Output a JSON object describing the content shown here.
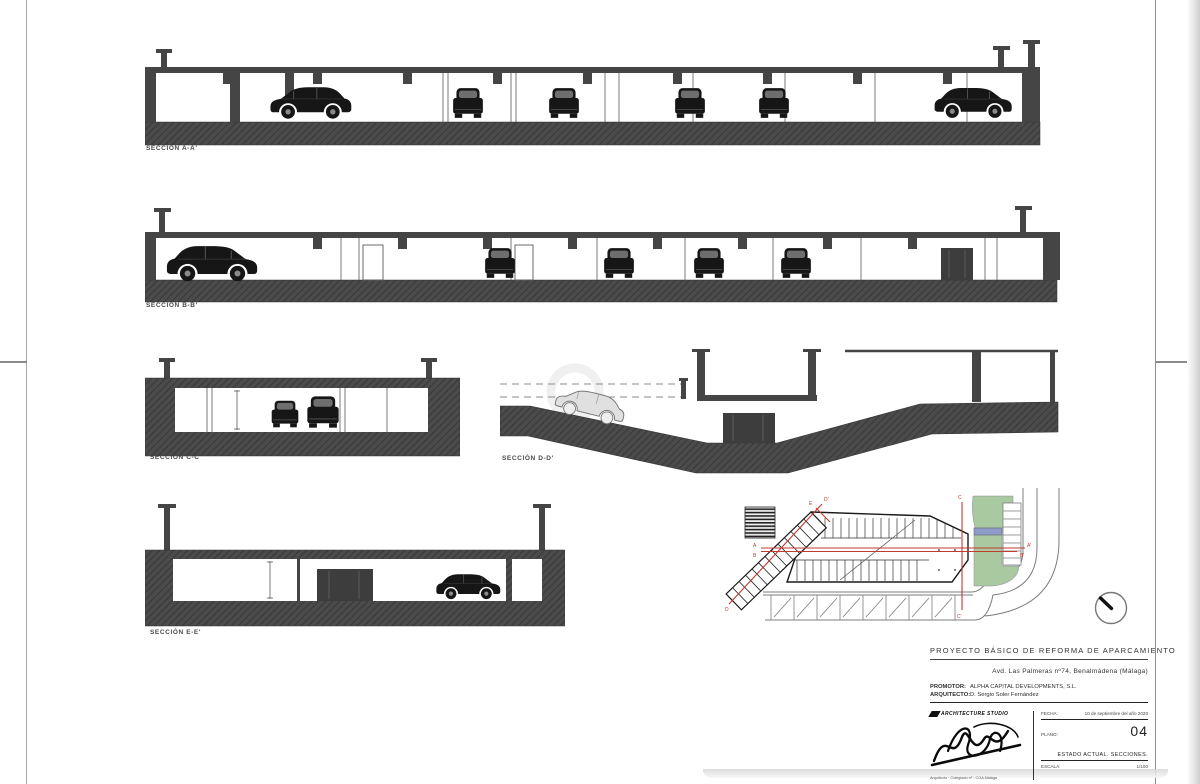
{
  "doc": {
    "type_note": "Scanned architecture sheet – parking reform sections",
    "colors": {
      "ink": "#454545",
      "slab": "#4b4b4b",
      "section_red": "#c13a2c",
      "green": "#a9c9a1",
      "blue": "#8c9cc6"
    }
  },
  "sections": [
    {
      "id": "a",
      "label": "SECCIÓN A-A'"
    },
    {
      "id": "b",
      "label": "SECCIÓN B-B'"
    },
    {
      "id": "c",
      "label": "SECCIÓN C-C'"
    },
    {
      "id": "d",
      "label": "SECCIÓN D-D'"
    },
    {
      "id": "e",
      "label": "SECCIÓN E-E'"
    }
  ],
  "plan": {
    "labels": {
      "a": "A",
      "a2": "A'",
      "b": "B",
      "b2": "B'",
      "c": "C",
      "c2": "C'",
      "d": "D",
      "d2": "D'",
      "e": "E"
    }
  },
  "titleblock": {
    "title": "PROYECTO BÁSICO DE REFORMA DE APARCAMIENTO",
    "address": "Avd. Las Palmeras nº74, Benalmádena (Málaga)",
    "promotor_label": "PROMOTOR:",
    "promotor": "ALPHA CAPITAL DEVELOPMENTS, S.L.",
    "arquitecto_label": "ARQUITECTO:",
    "arquitecto": "D. Sergio Soler Fernández",
    "logo_text": "ARCHITECTURE STUDIO",
    "firm_note": "Arquitecto · Colegiado nº · COA Málaga",
    "fecha_label": "FECHA:",
    "fecha": "10 de septiembre del año 2020",
    "plano_label": "PLANO:",
    "plano": "04",
    "estado": "ESTADO ACTUAL. SECCIONES.",
    "escala_label": "ESCALA:",
    "escala": "1/100"
  }
}
